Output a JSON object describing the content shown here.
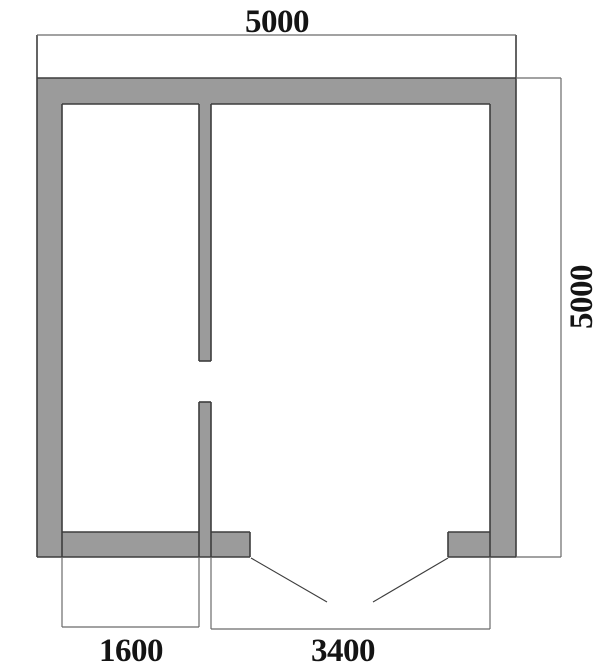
{
  "colors": {
    "background": "#ffffff",
    "wall_fill": "#9b9b9b",
    "outline": "#3d3d3d",
    "dimension_line": "#6a6a6a",
    "label": "#141414"
  },
  "floor_plan": {
    "dimension_labels": {
      "top_width": "5000",
      "right_height": "5000",
      "bottom_left_width": "1600",
      "bottom_right_width": "3400"
    }
  }
}
